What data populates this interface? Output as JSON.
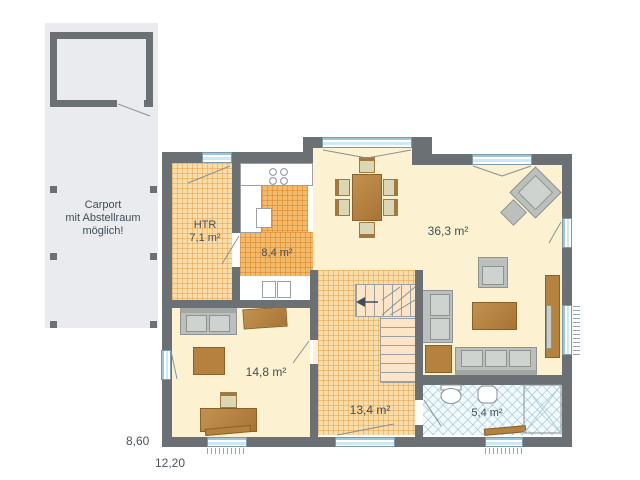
{
  "carport": {
    "note_line1": "Carport",
    "note_line2": "mit Abstellraum",
    "note_line3": "möglich!"
  },
  "rooms": {
    "htr": {
      "name": "HTR",
      "area": "7,1 m²"
    },
    "kitchen": {
      "area": "8,4 m²"
    },
    "living": {
      "area": "36,3 m²"
    },
    "office": {
      "area": "14,8 m²"
    },
    "hall": {
      "area": "13,4 m²"
    },
    "bath": {
      "area": "5,4 m²"
    }
  },
  "dimensions": {
    "left_section": "8,60",
    "total_width": "12,20"
  },
  "colors": {
    "wall": "#6b7074",
    "carport_slab": "#e9ebee",
    "cream_floor": "#fcf2d1",
    "tile_orange": "#f2ba6b",
    "bath_blue": "#f2fafd",
    "window_blue": "#cde9f5",
    "furniture_brown": "#b5813f",
    "furniture_gray": "#bcc0bc",
    "label_text": "#414e58"
  }
}
